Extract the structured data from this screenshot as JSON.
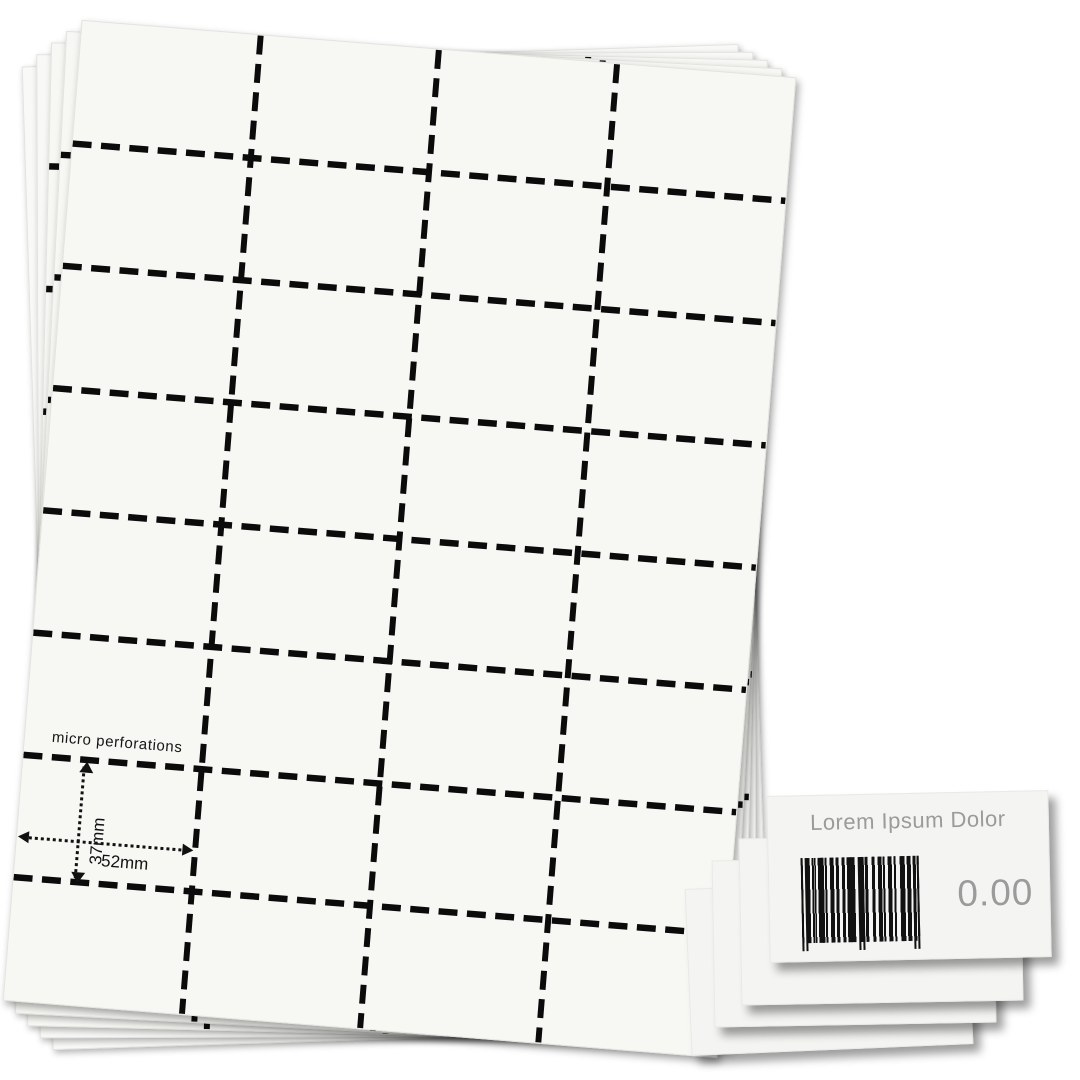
{
  "image_type": "product-photo of perforated price tag sheets",
  "paper_stack": {
    "sheets_visible": 5,
    "grid": {
      "columns": 4,
      "rows": 8
    },
    "annotations": {
      "perforation_note": "micro perforations",
      "cell_height": "37mm",
      "cell_width": "52mm"
    }
  },
  "price_tags": {
    "cards_visible": 4,
    "front_card": {
      "title": "Lorem Ipsum Dolor",
      "price": "0.00",
      "barcode": "barcode"
    }
  },
  "colors": {
    "background": "#ffffff",
    "paper": "#f7f7f4",
    "perforation_dash": "#0b0b0b",
    "tag_text": "#9b9b9b"
  }
}
